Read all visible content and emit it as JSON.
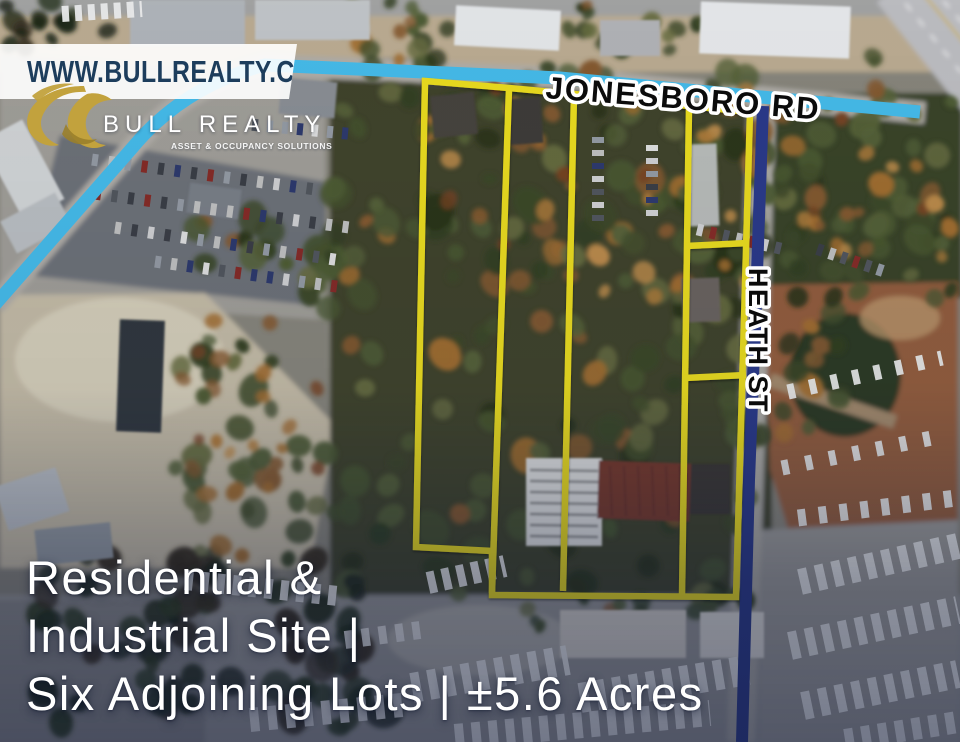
{
  "branding": {
    "website_banner": "WWW.BULLREALTY.COM",
    "company_name": "BULL REALTY",
    "company_tagline": "ASSET & OCCUPANCY SOLUTIONS"
  },
  "map_labels": {
    "jonesboro_road": "JONESBORO RD",
    "heath_street": "HEATH ST"
  },
  "headline": {
    "line1": "Residential &",
    "line2": "Industrial Site |",
    "line3": "Six Adjoining Lots | ±5.6 Acres"
  },
  "colors": {
    "road_highlight_cyan": "#47C2F1",
    "road_highlight_navy": "#2B3A8C",
    "lot_outline_yellow": "#F4E41A",
    "brand_gold": "#C2A23D",
    "banner_text_navy": "#1D3D5C",
    "headline_white": "#FFFFFF"
  }
}
